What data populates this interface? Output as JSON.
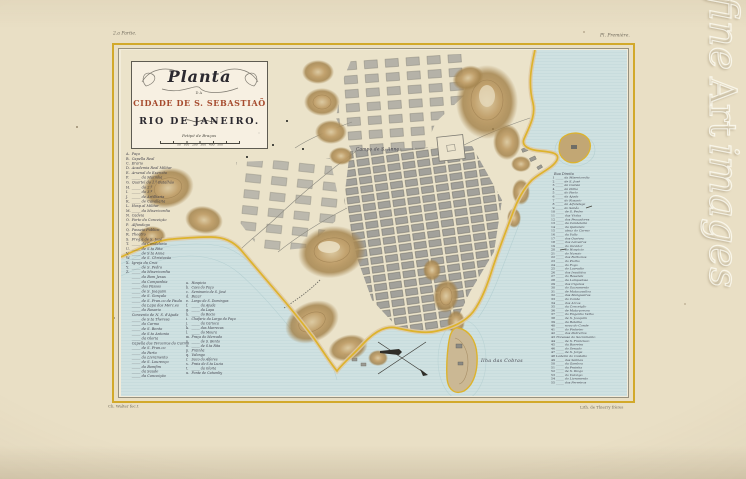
{
  "page": {
    "corner_left": "2.a Partie.",
    "corner_right": "Pl. Première.",
    "imprint_left": "Ch. Walter fec.t",
    "imprint_right": "Lith. de Thierry frères",
    "watermark": {
      "word1": "fine",
      "word2": "Art",
      "word3": "images"
    }
  },
  "cartouche": {
    "title_script": "Planta",
    "da": "DA",
    "city_line": "CIDADE DE S. SEBASTIAÕ",
    "do": "DO",
    "rio_line": "RIO DE JANEIRO.",
    "scale_label": "Petipé de Braças",
    "scale_ticks": [
      {
        "v": "50"
      },
      {
        "v": "100"
      },
      {
        "v": "200"
      },
      {
        "v": "300"
      },
      {
        "v": "400"
      },
      {
        "v": "500"
      }
    ]
  },
  "map_labels": {
    "campo": "Campo de S. Anna",
    "island": "Ilha  das Cobras"
  },
  "legend_left": {
    "entries": [
      {
        "k": "A.",
        "t": "Paço"
      },
      {
        "k": "B.",
        "t": "Capella Real"
      },
      {
        "k": "C.",
        "t": "Erario"
      },
      {
        "k": "D.",
        "t": "Academia Real Militar"
      },
      {
        "k": "E.",
        "t": "Arsenal do Exercito"
      },
      {
        "k": "F.",
        "t": "_____ da Marinha"
      },
      {
        "k": "G.",
        "t": "Quartel do 1.º Batalhão"
      },
      {
        "k": "H.",
        "t": "_____ do 2.º"
      },
      {
        "k": "I.",
        "t": "_____ do 3.º"
      },
      {
        "k": "J.",
        "t": "_____ de Artilharia"
      },
      {
        "k": "K.",
        "t": "_____ de Cavallaria"
      },
      {
        "k": "L.",
        "t": "Hosp.al Militar"
      },
      {
        "k": "M.",
        "t": "_____ da Misericordia"
      },
      {
        "k": "N.",
        "t": "Cadeia"
      },
      {
        "k": "O.",
        "t": "Forte da Conceição"
      },
      {
        "k": "P.",
        "t": "Alfandega"
      },
      {
        "k": "Q.",
        "t": "Passeio Publico"
      },
      {
        "k": "R.",
        "t": "Theatro"
      },
      {
        "k": "S.",
        "t": "Freg.a de S. José"
      },
      {
        "k": "T.",
        "t": "_____ da Candelaria"
      },
      {
        "k": "U.",
        "t": "_____ de S.ta Rita"
      },
      {
        "k": "V.",
        "t": "_____ de S.ta Anna"
      },
      {
        "k": "W.",
        "t": "_____ de S. Christovão"
      },
      {
        "k": "X.",
        "t": "Igreja da Cruz"
      },
      {
        "k": "Y.",
        "t": "_____ de S. Pedro"
      },
      {
        "k": "Z.",
        "t": "_____ da Misericordia"
      },
      {
        "k": "",
        "t": "_____ do Bom Jesus"
      },
      {
        "k": "",
        "t": "_____ da Companhia"
      },
      {
        "k": "",
        "t": "_____ dos Passos"
      },
      {
        "k": "",
        "t": "_____ de S. Joaquim"
      },
      {
        "k": "",
        "t": "_____ de S. Gonçalo"
      },
      {
        "k": "",
        "t": "_____ de S. Fran.co de Paula"
      },
      {
        "k": "",
        "t": "_____ da Lapa dos Merc.es"
      },
      {
        "k": "",
        "t": "_____ do Rosario"
      },
      {
        "k": "",
        "t": "Convento de N. S. d'Ajuda"
      },
      {
        "k": "",
        "t": "_____ de S.ta Theresa"
      },
      {
        "k": "",
        "t": "_____ do Carmo"
      },
      {
        "k": "",
        "t": "_____ de S. Bento"
      },
      {
        "k": "",
        "t": "_____ de S.to Antonio"
      },
      {
        "k": "",
        "t": "_____ da Gloria"
      },
      {
        "k": "",
        "t": "Capella dos Terceiros do Carmo"
      },
      {
        "k": "",
        "t": "_____ de S. Fran.co"
      },
      {
        "k": "",
        "t": "_____ do Parto"
      },
      {
        "k": "",
        "t": "_____ do Livramento"
      },
      {
        "k": "",
        "t": "_____ de S. Lourenço"
      },
      {
        "k": "",
        "t": "_____ do Bomfim"
      },
      {
        "k": "",
        "t": "_____ da Saude"
      },
      {
        "k": "",
        "t": "_____ da Conceição"
      }
    ]
  },
  "legend_sub": {
    "entries": [
      {
        "k": "a.",
        "t": "Hospicio"
      },
      {
        "k": "b.",
        "t": "Caes do Paço"
      },
      {
        "k": "c.",
        "t": "Seminario de S. José"
      },
      {
        "k": "d.",
        "t": "Bazar"
      },
      {
        "k": "e.",
        "t": "Largo de S. Domingos"
      },
      {
        "k": "f.",
        "t": "_____ da Ajuda"
      },
      {
        "k": "g.",
        "t": "_____ da Lapa"
      },
      {
        "k": "h.",
        "t": "_____ do Rocio"
      },
      {
        "k": "i.",
        "t": "Chafariz do Largo do Paço"
      },
      {
        "k": "j.",
        "t": "_____ da Carioca"
      },
      {
        "k": "k.",
        "t": "_____ das Marrecas"
      },
      {
        "k": "l.",
        "t": "_____ do Moura"
      },
      {
        "k": "m.",
        "t": "Praça do Mercado"
      },
      {
        "k": "n.",
        "t": "_____ de S. Bento"
      },
      {
        "k": "o.",
        "t": "_____ de S.ta Rita"
      },
      {
        "k": "p.",
        "t": "Prainha"
      },
      {
        "k": "q.",
        "t": "Valongo"
      },
      {
        "k": "r.",
        "t": "Saco do Alferes"
      },
      {
        "k": "s.",
        "t": "Praia de S.ta Luzia"
      },
      {
        "k": "t.",
        "t": "_____ da Gloria"
      },
      {
        "k": "u.",
        "t": "Ponte de Catumby"
      }
    ]
  },
  "legend_right": {
    "header": "Rua Direita",
    "entries": [
      {
        "k": "1",
        "t": "_____ da Misericordia"
      },
      {
        "k": "2",
        "t": "_____ de S. José"
      },
      {
        "k": "3",
        "t": "_____ da Cadeia"
      },
      {
        "k": "4",
        "t": "_____ da Palha"
      },
      {
        "k": "5",
        "t": "_____ do Parto"
      },
      {
        "k": "6",
        "t": "_____ da Ajuda"
      },
      {
        "k": "7",
        "t": "_____ do Rosario"
      },
      {
        "k": "8",
        "t": "_____ da Alfandega"
      },
      {
        "k": "9",
        "t": "_____ do Sabão"
      },
      {
        "k": "10",
        "t": "_____ de S. Pedro"
      },
      {
        "k": "11",
        "t": "_____ das Violas"
      },
      {
        "k": "12",
        "t": "_____ dos Pescadores"
      },
      {
        "k": "13",
        "t": "_____ da Candelaria"
      },
      {
        "k": "14",
        "t": "_____ da Quitanda"
      },
      {
        "k": "15",
        "t": "_____ atraz do Carmo"
      },
      {
        "k": "16",
        "t": "_____ da Valla"
      },
      {
        "k": "17",
        "t": "_____ dos Ourives"
      },
      {
        "k": "18",
        "t": "_____ dos Latoeiros"
      },
      {
        "k": "19",
        "t": "_____ do Ouvidor"
      },
      {
        "k": "20",
        "t": "_____ do Hospicio"
      },
      {
        "k": "21",
        "t": "_____ do Nuncio"
      },
      {
        "k": "22",
        "t": "_____ dos Barbonos"
      },
      {
        "k": "23",
        "t": "_____ do Piolho"
      },
      {
        "k": "24",
        "t": "_____ do Fogo"
      },
      {
        "k": "25",
        "t": "_____ do Lavradio"
      },
      {
        "k": "26",
        "t": "_____ dos Invalidos"
      },
      {
        "k": "27",
        "t": "_____ do Resende"
      },
      {
        "k": "28",
        "t": "_____ da Lampadosa"
      },
      {
        "k": "29",
        "t": "_____ dos Ciganos"
      },
      {
        "k": "30",
        "t": "_____ do Sacramento"
      },
      {
        "k": "31",
        "t": "_____ de Matacavallos"
      },
      {
        "k": "32",
        "t": "_____ das Mangueiras"
      },
      {
        "k": "33",
        "t": "_____ do Conde"
      },
      {
        "k": "34",
        "t": "_____ dos Arcos"
      },
      {
        "k": "35",
        "t": "_____ da Conceição"
      },
      {
        "k": "36",
        "t": "_____ de Mata-porcos"
      },
      {
        "k": "37",
        "t": "_____ do Engenho Velho"
      },
      {
        "k": "38",
        "t": "_____ de S. Joaquim"
      },
      {
        "k": "39",
        "t": "_____ da Batalha"
      },
      {
        "k": "40",
        "t": "_____ nova do Conde"
      },
      {
        "k": "41",
        "t": "_____ do Pinheiro"
      },
      {
        "k": "42",
        "t": "_____ dos Pedreiros"
      },
      {
        "k": "43",
        "t": "Travessa do Sacramento"
      },
      {
        "k": "44",
        "t": "_____ de S. Francisco"
      },
      {
        "k": "45",
        "t": "_____ da Barreira"
      },
      {
        "k": "46",
        "t": "_____ do Senado"
      },
      {
        "k": "47",
        "t": "_____ de S. Jorge"
      },
      {
        "k": "48",
        "t": "Ladeira do Castello"
      },
      {
        "k": "49",
        "t": "_____ das Salinas"
      },
      {
        "k": "50",
        "t": "_____ da Gamboa"
      },
      {
        "k": "51",
        "t": "_____ da Prainha"
      },
      {
        "k": "52",
        "t": "_____ de S. Diogo"
      },
      {
        "k": "53",
        "t": "_____ do Valongo"
      },
      {
        "k": "54",
        "t": "_____ do Livramento"
      },
      {
        "k": "55",
        "t": "_____ dos Ferreiros"
      }
    ]
  },
  "colors": {
    "paper": "#e9dfc5",
    "paper_light": "#f2ecda",
    "land": "#ebe3ca",
    "water": "#cfe1e1",
    "water_line": "#a9c8cb",
    "coast": "#ddb32c",
    "sand": "#dfc9a2",
    "hill": "#b99768",
    "hill_dark": "#8f7347",
    "block": "#a2a19b",
    "block_edge": "#6f6e66",
    "ink": "#3f3e49",
    "ink_light": "#6e685a",
    "title_red": "#a64b2e",
    "frame": "#d2a92b"
  }
}
